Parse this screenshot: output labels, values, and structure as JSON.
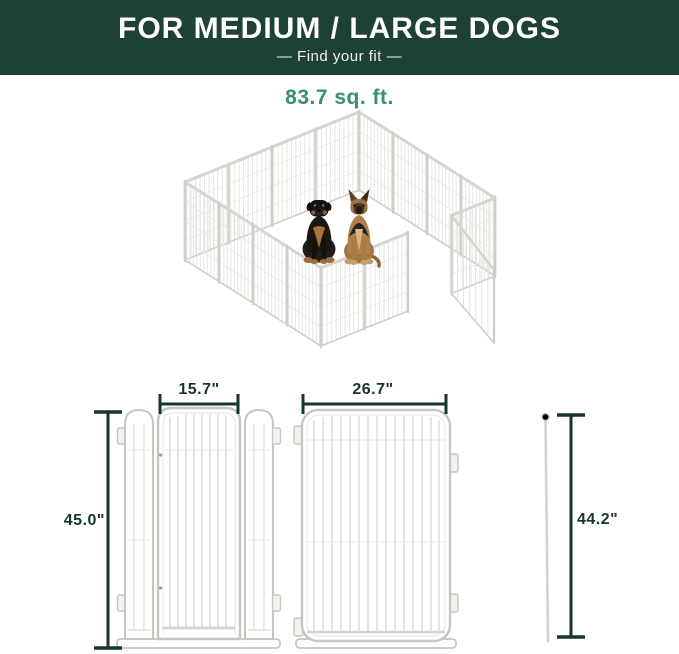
{
  "banner": {
    "title": "FOR MEDIUM / LARGE DOGS",
    "subtitle": "—  Find your fit  —"
  },
  "area_label": "83.7 sq. ft.",
  "illustration": {
    "description": "isometric 16-panel white metal dog playpen with open gate",
    "dogs": [
      {
        "breed": "Rottweiler"
      },
      {
        "breed": "German Shepherd"
      }
    ]
  },
  "dimensions": {
    "door_width": "15.7\"",
    "panel_width": "26.7\"",
    "door_height": "45.0\"",
    "stake_height": "44.2\""
  },
  "colors": {
    "banner_bg": "#1d4233",
    "banner_text": "#ffffff",
    "area_text": "#38906e",
    "dimension_line": "#17352a",
    "panel_outline": "#c6c6c1",
    "wire": "#d9d9d4"
  }
}
